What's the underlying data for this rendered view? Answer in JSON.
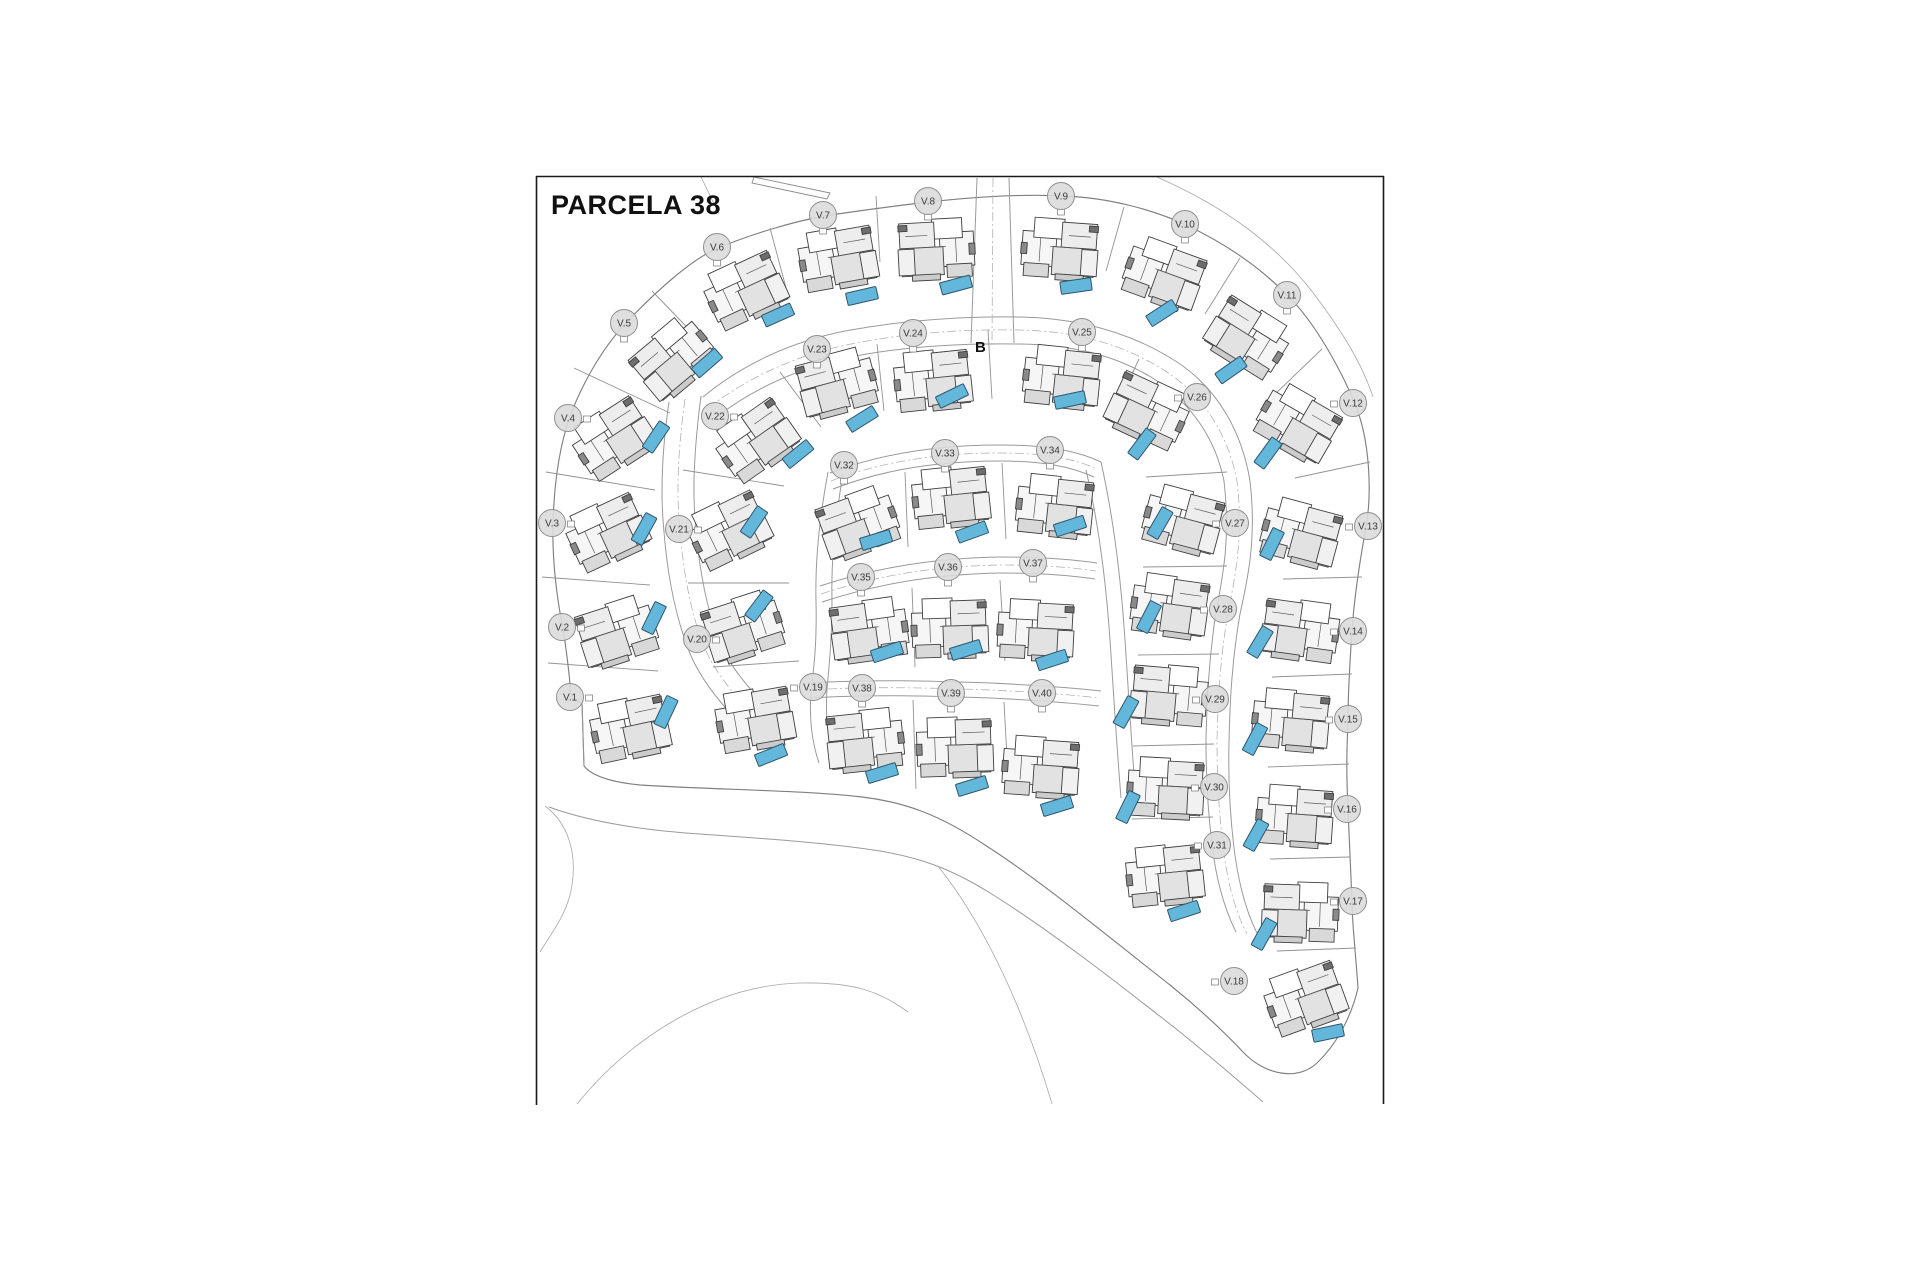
{
  "title": "PARCELA 38",
  "marker_b": "B",
  "colors": {
    "pool": "#63B7DA",
    "pool_border": "#2F566B",
    "label_fill": "#DBDBDB",
    "label_border": "#8F8F8F",
    "label_text": "#3C3C3C",
    "title_color": "#111111",
    "line": "#999999",
    "wall": "#3F3F3F",
    "frame": "#1A1A1A"
  },
  "frame": {
    "left": 536,
    "top": 176,
    "right": 1384,
    "bottom": 1105
  },
  "plots": [
    {
      "l": "V.1",
      "x": 570,
      "y": 697,
      "t": "e",
      "hx": 630,
      "hy": 728,
      "hr": -12,
      "px": 666,
      "py": 712,
      "pr": -65
    },
    {
      "l": "V.2",
      "x": 562,
      "y": 627,
      "t": "e",
      "hx": 617,
      "hy": 632,
      "hr": -18,
      "px": 654,
      "py": 618,
      "pr": -64
    },
    {
      "l": "V.3",
      "x": 552,
      "y": 523,
      "t": "e",
      "hx": 607,
      "hy": 532,
      "hr": -25,
      "px": 644,
      "py": 529,
      "pr": -61
    },
    {
      "l": "V.4",
      "x": 568,
      "y": 418,
      "t": "e",
      "hx": 613,
      "hy": 438,
      "hr": -33,
      "px": 656,
      "py": 437,
      "pr": -56
    },
    {
      "l": "V.5",
      "x": 624,
      "y": 323,
      "t": "s",
      "hx": 673,
      "hy": 358,
      "hr": -40,
      "px": 707,
      "py": 363,
      "pr": -41
    },
    {
      "l": "V.6",
      "x": 717,
      "y": 247,
      "t": "s",
      "hx": 745,
      "hy": 290,
      "hr": -25,
      "px": 778,
      "py": 315,
      "pr": -24
    },
    {
      "l": "V.7",
      "x": 823,
      "y": 215,
      "t": "s",
      "hx": 838,
      "hy": 258,
      "hr": -10,
      "px": 862,
      "py": 296,
      "pr": -13
    },
    {
      "l": "V.8",
      "x": 928,
      "y": 201,
      "t": "s",
      "hx": 936,
      "hy": 249,
      "hr": -3,
      "px": 956,
      "py": 285,
      "pr": -15
    },
    {
      "l": "V.9",
      "x": 1061,
      "y": 196,
      "t": "s",
      "hx": 1060,
      "hy": 249,
      "hr": 4,
      "px": 1076,
      "py": 286,
      "pr": -8
    },
    {
      "l": "V.10",
      "x": 1185,
      "y": 224,
      "t": "s",
      "hx": 1164,
      "hy": 274,
      "hr": 20,
      "px": 1162,
      "py": 313,
      "pr": -33
    },
    {
      "l": "V.11",
      "x": 1287,
      "y": 295,
      "t": "s",
      "hx": 1248,
      "hy": 337,
      "hr": 32,
      "px": 1231,
      "py": 370,
      "pr": -35
    },
    {
      "l": "V.12",
      "x": 1353,
      "y": 403,
      "t": "w",
      "hx": 1298,
      "hy": 423,
      "hr": 30,
      "px": 1268,
      "py": 453,
      "pr": -54
    },
    {
      "l": "V.13",
      "x": 1368,
      "y": 526,
      "t": "w",
      "hx": 1301,
      "hy": 533,
      "hr": 15,
      "px": 1272,
      "py": 544,
      "pr": -64
    },
    {
      "l": "V.14",
      "x": 1353,
      "y": 631,
      "t": "w",
      "hx": 1300,
      "hy": 630,
      "hr": 8,
      "px": 1260,
      "py": 642,
      "pr": -59
    },
    {
      "l": "V.15",
      "x": 1348,
      "y": 719,
      "t": "w",
      "hx": 1291,
      "hy": 720,
      "hr": 5,
      "px": 1255,
      "py": 739,
      "pr": -62
    },
    {
      "l": "V.16",
      "x": 1347,
      "y": 809,
      "t": "w",
      "hx": 1295,
      "hy": 816,
      "hr": 4,
      "px": 1256,
      "py": 835,
      "pr": -61
    },
    {
      "l": "V.17",
      "x": 1353,
      "y": 901,
      "t": "w",
      "hx": 1300,
      "hy": 912,
      "hr": 2,
      "px": 1264,
      "py": 934,
      "pr": -61
    },
    {
      "l": "V.18",
      "x": 1234,
      "y": 981,
      "t": "w",
      "hx": 1305,
      "hy": 998,
      "hr": -20,
      "px": 1328,
      "py": 1033,
      "pr": -12
    },
    {
      "l": "V.19",
      "x": 813,
      "y": 687,
      "t": "w",
      "hx": 755,
      "hy": 719,
      "hr": -10,
      "px": 771,
      "py": 755,
      "pr": -22
    },
    {
      "l": "V.20",
      "x": 697,
      "y": 639,
      "t": "e",
      "hx": 743,
      "hy": 627,
      "hr": -18,
      "px": 759,
      "py": 606,
      "pr": -53
    },
    {
      "l": "V.21",
      "x": 679,
      "y": 529,
      "t": "e",
      "hx": 729,
      "hy": 530,
      "hr": -26,
      "px": 754,
      "py": 522,
      "pr": -56
    },
    {
      "l": "V.22",
      "x": 715,
      "y": 416,
      "t": "e",
      "hx": 756,
      "hy": 440,
      "hr": -35,
      "px": 798,
      "py": 454,
      "pr": -39
    },
    {
      "l": "V.23",
      "x": 817,
      "y": 349,
      "t": "s",
      "hx": 837,
      "hy": 383,
      "hr": -15,
      "px": 862,
      "py": 419,
      "pr": -32
    },
    {
      "l": "V.24",
      "x": 913,
      "y": 333,
      "t": "s",
      "hx": 933,
      "hy": 380,
      "hr": -6,
      "px": 952,
      "py": 396,
      "pr": -26
    },
    {
      "l": "V.25",
      "x": 1082,
      "y": 332,
      "t": "s",
      "hx": 1062,
      "hy": 377,
      "hr": 6,
      "px": 1070,
      "py": 400,
      "pr": -12
    },
    {
      "l": "V.26",
      "x": 1197,
      "y": 397,
      "t": "w",
      "hx": 1148,
      "hy": 410,
      "hr": 25,
      "px": 1142,
      "py": 444,
      "pr": -53
    },
    {
      "l": "V.27",
      "x": 1235,
      "y": 523,
      "t": "w",
      "hx": 1183,
      "hy": 520,
      "hr": 15,
      "px": 1160,
      "py": 523,
      "pr": -60
    },
    {
      "l": "V.28",
      "x": 1223,
      "y": 609,
      "t": "w",
      "hx": 1170,
      "hy": 606,
      "hr": 8,
      "px": 1149,
      "py": 617,
      "pr": -63
    },
    {
      "l": "V.29",
      "x": 1215,
      "y": 699,
      "t": "w",
      "hx": 1169,
      "hy": 695,
      "hr": 5,
      "px": 1126,
      "py": 712,
      "pr": -61
    },
    {
      "l": "V.30",
      "x": 1214,
      "y": 787,
      "t": "w",
      "hx": 1166,
      "hy": 788,
      "hr": 3,
      "px": 1128,
      "py": 807,
      "pr": -64
    },
    {
      "l": "V.31",
      "x": 1217,
      "y": 845,
      "t": "w",
      "hx": 1165,
      "hy": 875,
      "hr": -6,
      "px": 1184,
      "py": 911,
      "pr": -18
    },
    {
      "l": "V.32",
      "x": 844,
      "y": 465,
      "t": "s",
      "hx": 858,
      "hy": 523,
      "hr": -20,
      "px": 876,
      "py": 540,
      "pr": -17
    },
    {
      "l": "V.33",
      "x": 945,
      "y": 453,
      "t": "s",
      "hx": 951,
      "hy": 497,
      "hr": -6,
      "px": 972,
      "py": 532,
      "pr": -20
    },
    {
      "l": "V.34",
      "x": 1050,
      "y": 450,
      "t": "s",
      "hx": 1055,
      "hy": 506,
      "hr": 6,
      "px": 1070,
      "py": 526,
      "pr": -18
    },
    {
      "l": "V.35",
      "x": 861,
      "y": 577,
      "t": "s",
      "hx": 869,
      "hy": 630,
      "hr": -8,
      "px": 887,
      "py": 652,
      "pr": -18
    },
    {
      "l": "V.36",
      "x": 948,
      "y": 567,
      "t": "s",
      "hx": 950,
      "hy": 628,
      "hr": -2,
      "px": 966,
      "py": 650,
      "pr": -17
    },
    {
      "l": "V.37",
      "x": 1033,
      "y": 563,
      "t": "s",
      "hx": 1036,
      "hy": 630,
      "hr": 3,
      "px": 1052,
      "py": 660,
      "pr": -18
    },
    {
      "l": "V.38",
      "x": 862,
      "y": 688,
      "t": "s",
      "hx": 865,
      "hy": 740,
      "hr": -6,
      "px": 882,
      "py": 773,
      "pr": -17
    },
    {
      "l": "V.39",
      "x": 951,
      "y": 693,
      "t": "s",
      "hx": 955,
      "hy": 747,
      "hr": -2,
      "px": 972,
      "py": 786,
      "pr": -17
    },
    {
      "l": "V.40",
      "x": 1042,
      "y": 693,
      "t": "s",
      "hx": 1041,
      "hy": 767,
      "hr": 4,
      "px": 1057,
      "py": 806,
      "pr": -17
    }
  ],
  "map": {
    "house_parts": [
      {
        "x": -38,
        "y": -16,
        "w": 34,
        "h": 34,
        "f": "#f6f6f6"
      },
      {
        "x": -27,
        "y": -30,
        "w": 30,
        "h": 20,
        "f": "#ffffff"
      },
      {
        "x": 1,
        "y": -27,
        "w": 35,
        "h": 28,
        "f": "#ededed"
      },
      {
        "x": -7,
        "y": -2,
        "w": 42,
        "h": 28,
        "f": "#e2e2e2"
      },
      {
        "x": -35,
        "y": 16,
        "w": 25,
        "h": 13,
        "f": "#d9d9d9"
      },
      {
        "x": 22,
        "y": -1,
        "w": 16,
        "h": 26,
        "f": "#f1f1f1"
      },
      {
        "x": -39,
        "y": -4,
        "w": 6,
        "h": 11,
        "f": "#8a8a8a"
      },
      {
        "x": 28,
        "y": -25,
        "w": 9,
        "h": 6,
        "f": "#6e6e6e"
      },
      {
        "x": -3,
        "y": 25,
        "w": 28,
        "h": 6,
        "f": "#cccccc"
      }
    ],
    "house_lines": [
      [
        -20,
        -10,
        -20,
        14
      ],
      [
        8,
        -14,
        30,
        -14
      ],
      [
        -10,
        -2,
        14,
        -2
      ]
    ],
    "pool": {
      "w": 31,
      "h": 12.5
    },
    "roads": [
      {
        "n": "parcel-outer-boundary",
        "c": "boundary",
        "d": "M 582,703 L 584,766 C 592,776 610,782 640,785 C 720,790 800,790 862,797 C 905,802 940,815 985,845 C 1040,880 1110,938 1170,985 C 1205,1013 1228,1036 1245,1054 C 1266,1075 1298,1081 1317,1063 C 1336,1045 1351,1018 1358,988 C 1355,945 1352,922 1352,901 C 1350,860 1349,835 1348,809 C 1346,770 1347,745 1348,719 C 1348,690 1350,660 1352,631 C 1354,600 1360,560 1366,527 C 1372,493 1370,440 1355,404 C 1342,372 1315,322 1288,296 C 1255,262 1218,240 1186,225 C 1152,209 1105,197 1062,196 C 1020,194 972,197 929,202 C 893,206 858,211 824,216 C 792,222 752,234 718,248 C 692,259 656,291 625,324 C 601,350 581,386 569,419 C 559,449 554,486 553,524 C 552,560 557,600 563,628 C 567,655 570,678 571,698 C 575,701 578,702 582,703"
      },
      {
        "n": "ring-road-north-edge",
        "c": "road",
        "d": "M 703,397 C 745,362 795,341 845,331 C 905,320 962,316 1020,317 C 1080,318 1132,333 1177,362 C 1218,389 1242,432 1250,481 C 1257,540 1247,582 1240,614 C 1232,660 1230,700 1229,741 C 1228,780 1230,815 1234,848 C 1238,880 1245,910 1258,935"
      },
      {
        "n": "ring-road-south-edge",
        "c": "road",
        "d": "M 714,419 C 752,389 797,369 846,358 C 903,346 962,343 1020,344 C 1071,345 1112,354 1151,377 C 1190,402 1215,437 1224,481 C 1231,540 1222,580 1216,612 C 1209,658 1207,698 1206,740 C 1206,778 1208,812 1212,845 C 1216,878 1224,908 1236,932"
      },
      {
        "n": "west-road-outer-edge",
        "c": "road",
        "d": "M 669,402 C 662,450 660,492 664,532 C 668,582 677,622 691,656 C 700,676 714,696 734,717"
      },
      {
        "n": "west-road-inner-edge",
        "c": "road",
        "d": "M 701,396 C 694,450 692,492 696,530 C 700,576 708,614 721,646 C 731,667 748,688 770,710"
      },
      {
        "n": "inner-loop-top-outer",
        "c": "road",
        "d": "M 830,473 C 882,453 940,445 1000,445 C 1048,445 1078,451 1101,462"
      },
      {
        "n": "inner-loop-top-inner",
        "c": "road",
        "d": "M 833,489 C 884,469 941,461 1000,461 C 1044,461 1072,467 1094,477"
      },
      {
        "n": "inner-loop-west-outer",
        "c": "road",
        "d": "M 828,472 C 819,520 815,562 816,602 C 817,642 814,667 811,691 C 809,720 812,742 819,763"
      },
      {
        "n": "inner-loop-west-inner",
        "c": "road",
        "d": "M 843,474 C 835,520 831,562 832,600 C 832,640 829,666 827,689 C 825,716 828,738 834,758"
      },
      {
        "n": "inner-loop-east-outer",
        "c": "road",
        "d": "M 1101,462 C 1114,520 1121,580 1125,640 C 1129,700 1132,752 1136,800"
      },
      {
        "n": "inner-loop-east-inner",
        "c": "road",
        "d": "M 1086,470 C 1099,525 1106,582 1110,640 C 1114,700 1117,750 1121,798"
      },
      {
        "n": "cross-road-1-north",
        "c": "road",
        "d": "M 820,586 C 880,566 940,558 1000,557 C 1041,557 1070,559 1097,563"
      },
      {
        "n": "cross-road-1-south",
        "c": "road",
        "d": "M 822,602 C 882,582 941,574 1000,573 C 1040,573 1068,575 1095,579"
      },
      {
        "n": "cross-road-2-north",
        "c": "road",
        "d": "M 811,683 C 871,679 931,681 991,683 C 1031,685 1066,687 1101,691"
      },
      {
        "n": "cross-road-2-south",
        "c": "road",
        "d": "M 811,698 C 871,694 931,696 991,698 C 1031,700 1063,702 1099,706"
      },
      {
        "n": "entrance-road-west",
        "c": "road",
        "d": "M 977,178 L 971,343"
      },
      {
        "n": "entrance-road-east",
        "c": "road",
        "d": "M 1009,178 L 1014,343"
      },
      {
        "n": "diagonal-road-lower-edge",
        "c": "road",
        "d": "M 549,807 C 590,822 640,830 700,834 C 770,839 830,843 880,851 C 920,858 950,868 990,893 C 1050,930 1120,985 1175,1028 C 1210,1056 1240,1082 1263,1102"
      },
      {
        "n": "south-branch-road",
        "c": "thin",
        "d": "M 938,866 C 985,925 1025,1012 1052,1104"
      },
      {
        "n": "bottom-sweep-road",
        "c": "thin",
        "d": "M 577,1104 C 636,1032 718,985 801,983 C 856,982 880,992 908,1012"
      },
      {
        "n": "left-terrain-curve",
        "c": "thin",
        "d": "M 545,806 C 568,823 577,853 572,885 C 568,913 552,932 540,952"
      },
      {
        "n": "outer-arc-northeast",
        "c": "thin",
        "d": "M 1157,177 C 1225,207 1276,244 1314,294 C 1344,334 1362,364 1373,397"
      },
      {
        "n": "title-corner-diagonal",
        "c": "thin",
        "d": "M 701,177 L 719,214"
      },
      {
        "n": "neighbor-strip",
        "c": "whiteshape",
        "d": "M 754,177 L 830,193 L 827,199 L 752,183 Z"
      },
      {
        "n": "entrance-centerline",
        "c": "center",
        "d": "M 993,178 L 992,345"
      },
      {
        "n": "ring-road-centerline",
        "c": "center",
        "d": "M 708,408 C 750,376 798,355 846,345 C 904,333 962,329 1020,330 C 1076,331 1122,344 1164,370 C 1204,396 1228,434 1237,481 C 1244,540 1234,581 1228,613 C 1220,659 1218,699 1217,740 C 1217,779 1219,813 1223,846 C 1227,879 1234,909 1247,934"
      },
      {
        "n": "west-road-centerline",
        "c": "center",
        "d": "M 685,399 C 678,450 676,492 680,531 C 684,579 692,618 706,651 C 716,672 731,692 752,713"
      },
      {
        "n": "cross-road-1-centerline",
        "c": "center",
        "d": "M 821,594 C 881,574 940,566 1000,565 C 1040,565 1069,567 1096,571"
      },
      {
        "n": "cross-road-2-centerline",
        "c": "center",
        "d": "M 811,690 C 871,686 931,688 991,690 C 1031,692 1064,694 1100,698"
      },
      {
        "n": "inner-loop-top-centerline",
        "c": "center",
        "d": "M 831,481 C 883,461 940,453 1000,453 C 1046,453 1075,459 1097,469"
      }
    ],
    "dividers": [
      [
        548,
        663,
        658,
        671
      ],
      [
        542,
        577,
        650,
        585
      ],
      [
        546,
        472,
        655,
        490
      ],
      [
        574,
        368,
        670,
        413
      ],
      [
        652,
        291,
        711,
        352
      ],
      [
        770,
        228,
        789,
        299
      ],
      [
        876,
        196,
        880,
        262
      ],
      [
        1124,
        207,
        1106,
        271
      ],
      [
        1240,
        258,
        1205,
        314
      ],
      [
        1322,
        349,
        1272,
        397
      ],
      [
        1370,
        462,
        1295,
        478
      ],
      [
        1362,
        577,
        1283,
        579
      ],
      [
        1352,
        674,
        1272,
        677
      ],
      [
        1349,
        764,
        1268,
        767
      ],
      [
        1350,
        857,
        1270,
        859
      ],
      [
        1356,
        948,
        1277,
        951
      ],
      [
        713,
        667,
        799,
        661
      ],
      [
        688,
        583,
        789,
        583
      ],
      [
        683,
        470,
        784,
        486
      ],
      [
        780,
        372,
        821,
        427
      ],
      [
        877,
        344,
        884,
        411
      ],
      [
        988,
        330,
        992,
        399
      ],
      [
        1139,
        359,
        1111,
        419
      ],
      [
        1227,
        472,
        1146,
        477
      ],
      [
        1227,
        566,
        1143,
        567
      ],
      [
        1219,
        654,
        1138,
        655
      ],
      [
        1214,
        744,
        1133,
        746
      ],
      [
        1213,
        817,
        1132,
        819
      ],
      [
        905,
        472,
        908,
        547
      ],
      [
        1002,
        463,
        1006,
        539
      ],
      [
        912,
        588,
        915,
        667
      ],
      [
        1000,
        580,
        1005,
        661
      ],
      [
        913,
        700,
        916,
        789
      ],
      [
        1004,
        702,
        1009,
        794
      ],
      [
        582,
        703,
        584,
        766
      ]
    ]
  }
}
